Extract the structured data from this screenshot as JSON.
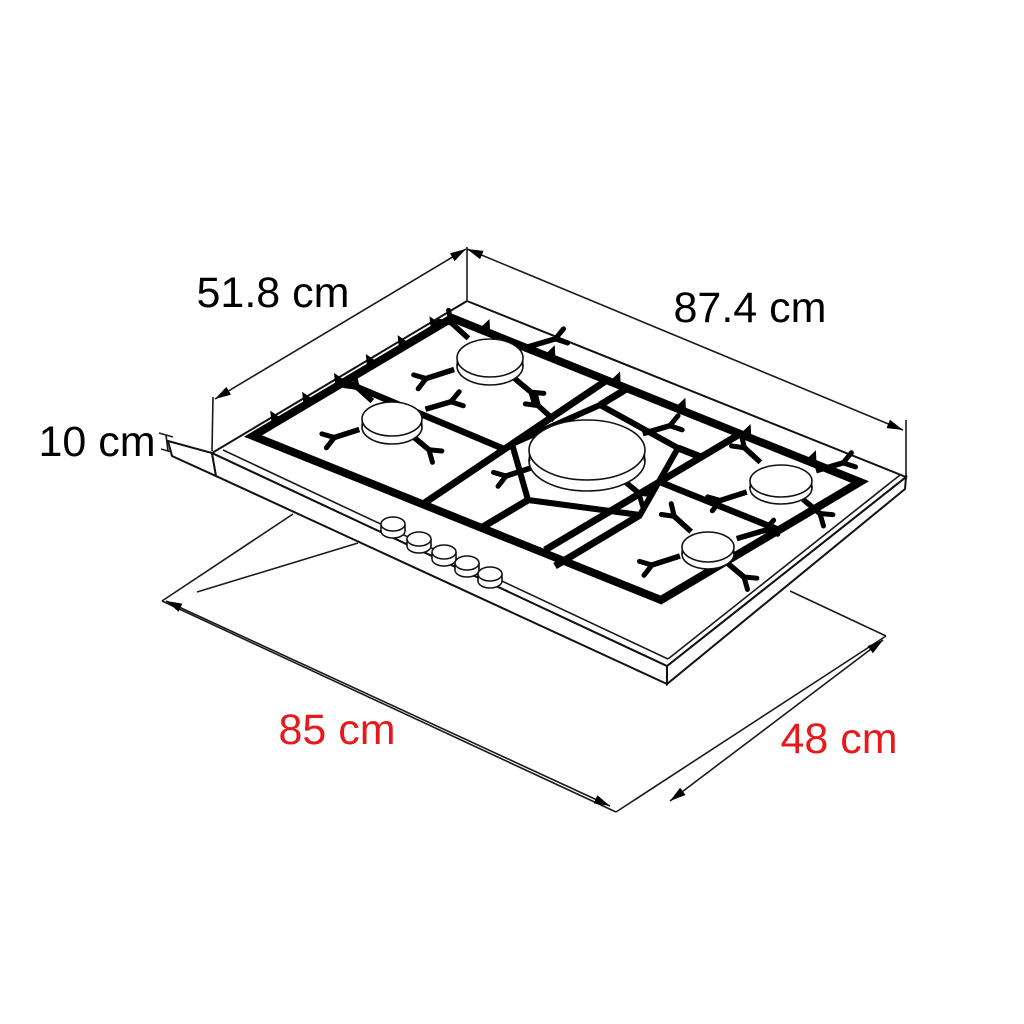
{
  "page": {
    "background": "#ffffff",
    "description": "Isometric line diagram of a five-burner gas hob with top dimensions and worktop cutout dimensions"
  },
  "labels": {
    "top_width": "87.4 cm",
    "top_depth": "51.8 cm",
    "front_height": "10 cm",
    "cutout_width": "85 cm",
    "cutout_depth": "48 cm"
  },
  "colors": {
    "dimension_text_black": "#000000",
    "cutout_text_red": "#e8191c",
    "line_color": "#111111"
  },
  "figure": {
    "burner_count": 5,
    "knob_count": 5
  }
}
